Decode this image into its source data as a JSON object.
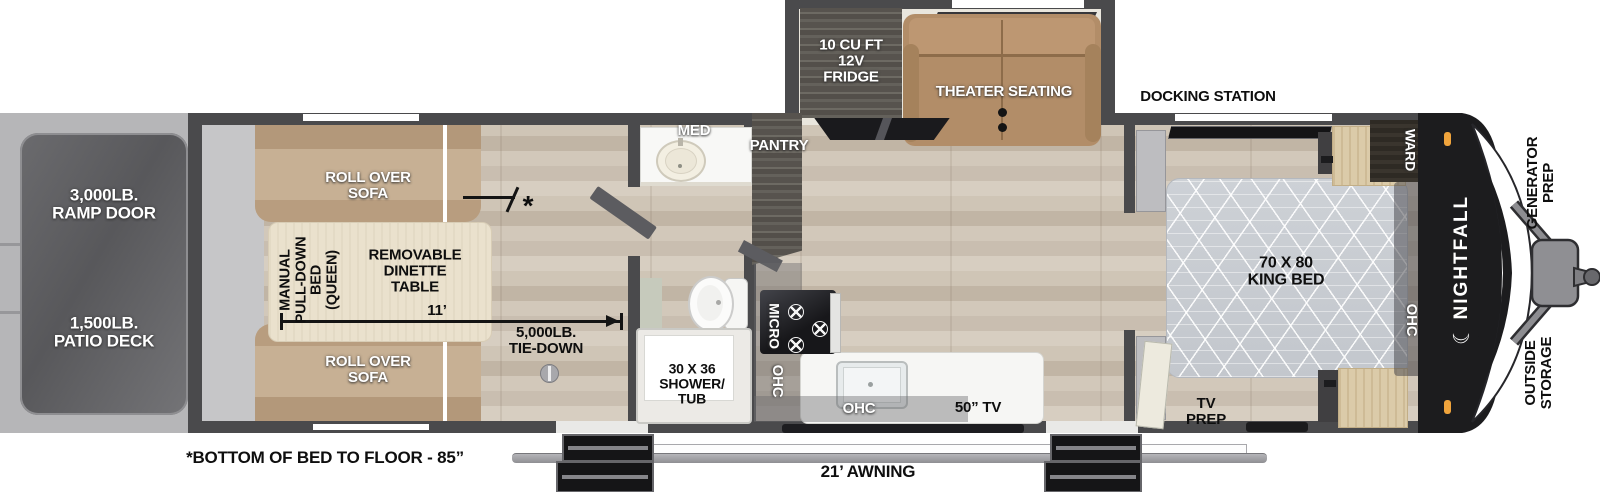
{
  "exterior": {
    "ramp_door": "3,000LB.\nRAMP DOOR",
    "patio_deck": "1,500LB.\nPATIO DECK",
    "docking_station": "DOCKING STATION",
    "generator_prep": "GENERATOR\nPREP",
    "outside_storage": "OUTSIDE\nSTORAGE",
    "awning": "21’ AWNING",
    "bottom_note": "*BOTTOM OF BED TO FLOOR - 85”",
    "brand": "NIGHTFALL",
    "brand_moon": "☾"
  },
  "garage": {
    "sofa_top": "ROLL OVER\nSOFA",
    "sofa_bottom": "ROLL OVER\nSOFA",
    "pulldown_bed": "MANUAL\nPULL-DOWN\nBED\n(QUEEN)",
    "dinette": "REMOVABLE\nDINETTE\nTABLE",
    "length": "11’",
    "tie_down": "5,000LB.\nTIE-DOWN",
    "asterisk": "*"
  },
  "bathroom": {
    "med": "MED",
    "pantry": "PANTRY",
    "shower": "30 X 36\nSHOWER/\nTUB"
  },
  "kitchen": {
    "micro": "MICRO",
    "ohc_vertical": "OHC",
    "ohc_lower": "OHC",
    "tv": "50” TV"
  },
  "living": {
    "fridge": "10 CU FT\n12V\nFRIDGE",
    "theater": "THEATER SEATING"
  },
  "bedroom": {
    "bed": "70 X 80\nKING BED",
    "ward": "WARD",
    "ohc": "OHC",
    "tv_prep": "TV\nPREP"
  },
  "colors": {
    "wall": "#4a4a4c",
    "floor_wood": "#cdc3b5",
    "sofa_tan": "#c7b094",
    "theater_seat": "#b28d68",
    "cabinet_dark_wood": "#57534e",
    "front_cap": "#1c1c1e",
    "marker_light_orange": "#f0a43c",
    "mattress_gray": "#c9cdd2"
  }
}
